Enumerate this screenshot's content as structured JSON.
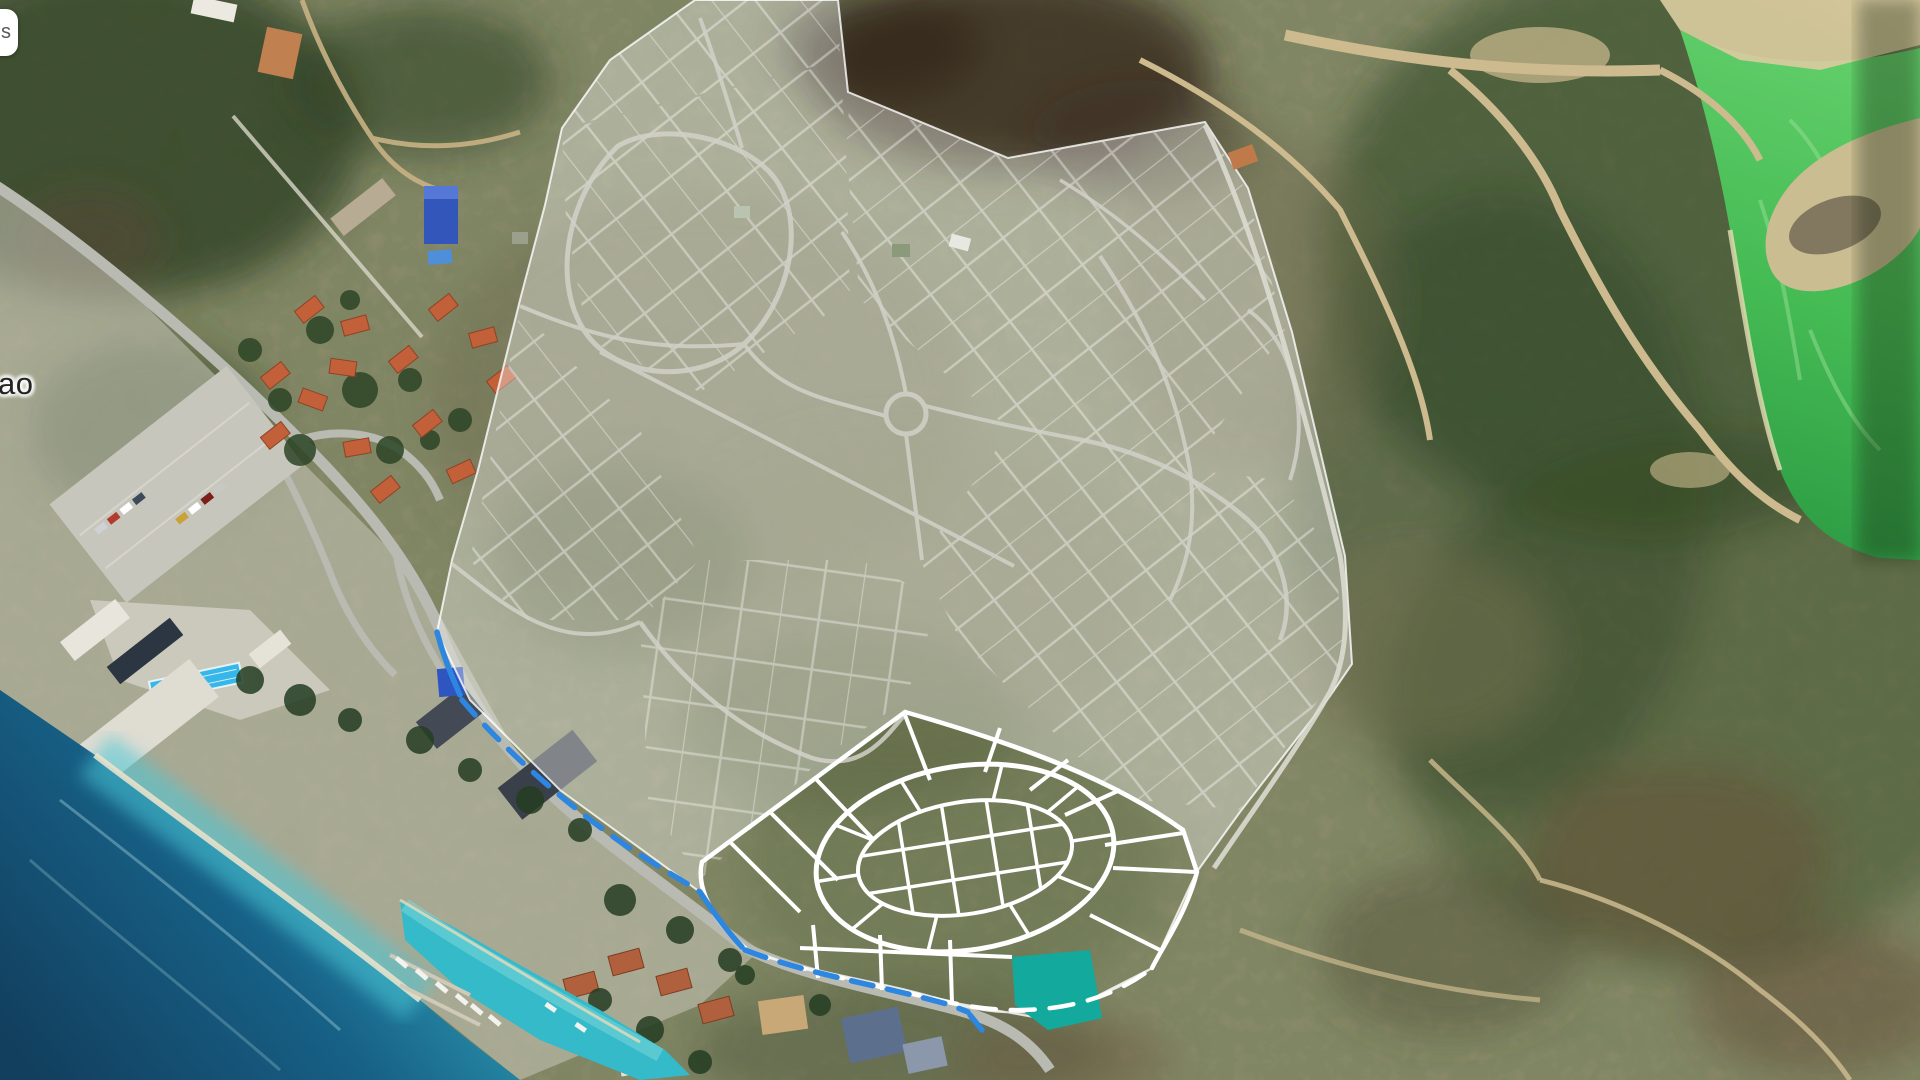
{
  "map_ui": {
    "partial_control_button_label": "s",
    "partial_place_label": "ao"
  },
  "map_colors": {
    "selected_parcel_teal": "#13a99c",
    "route_blue": "#2d86df",
    "parcel_line_white": "#ffffff",
    "overlay_wash": "rgba(244,245,241,0.38)",
    "overlay_parcel_line": "rgba(255,255,255,0.55)",
    "road_gray": "#b9bab2",
    "dirt_trail_tan": "#c9b285",
    "ocean_deep": "#14587d",
    "ocean_shallow": "#47c5d5",
    "lagoon_green": "#4cc258",
    "roof_orange": "#c2603a",
    "roof_blue": "#3356bb"
  }
}
